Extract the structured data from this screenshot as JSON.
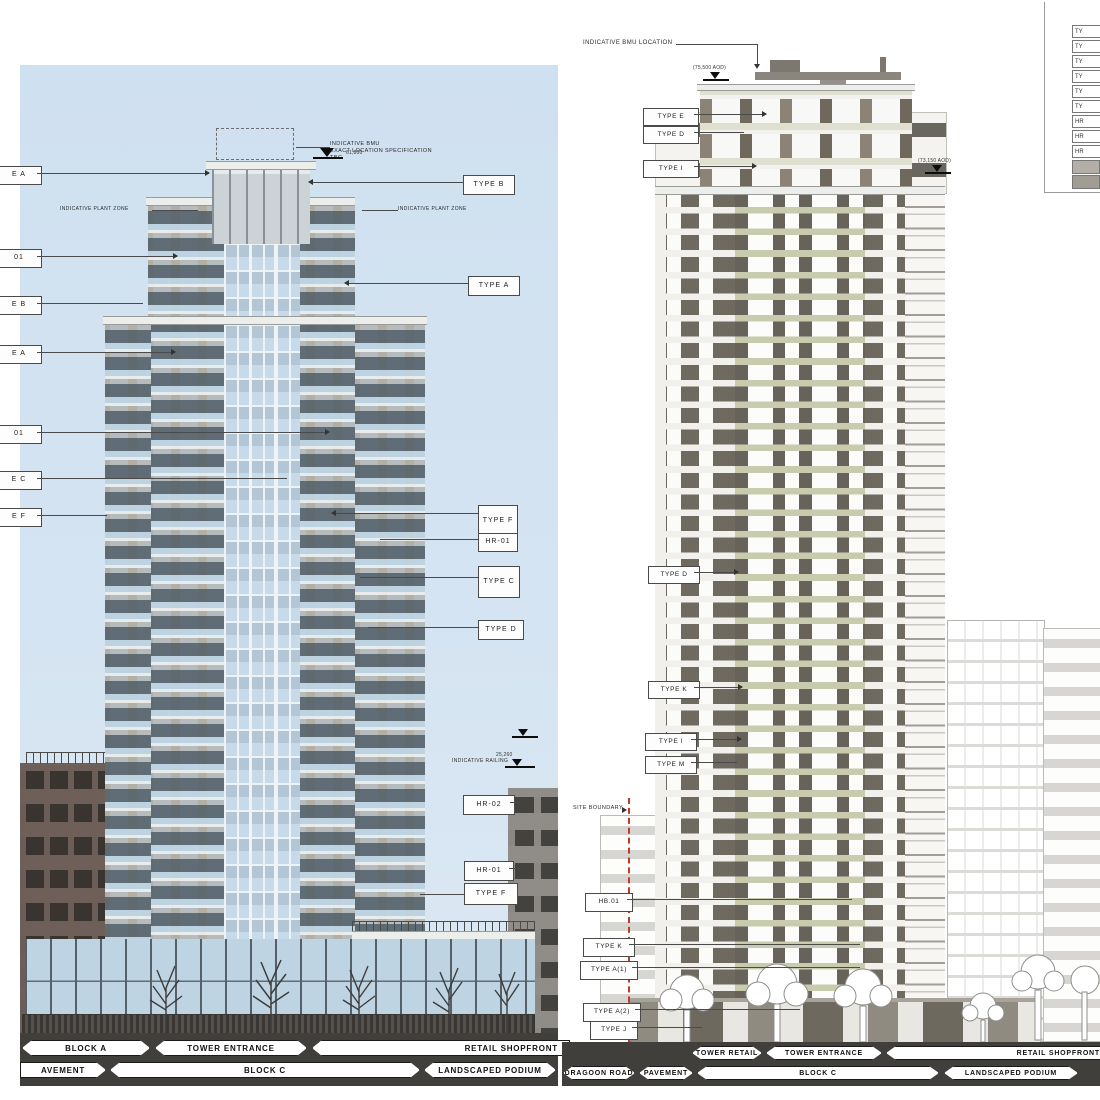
{
  "colors": {
    "sky": "#cfe0f0",
    "boundary_red": "#c0392b",
    "road_band": "#413f3c",
    "left_facade": "#b2afa7",
    "right_facade_dark": "#6f6a60",
    "right_balcony_olive": "#c8cbae"
  },
  "left_panel": {
    "bmu_note_line1": "INDICATIVE BMU",
    "bmu_note_line2": "EXACT LOCATION SPECIFICATION",
    "bmu_note_line3": "TBC",
    "bmu_level": "61,800",
    "plant_zone_left": "INDICATIVE PLANT ZONE",
    "plant_zone_right": "INDICATIVE PLANT ZONE",
    "railing_note": "INDICATIVE RAILING",
    "railing_level": "25,260",
    "edge_labels": [
      "E A",
      "01",
      "E B",
      "E A",
      "01",
      "E C",
      "E F"
    ],
    "right_labels": [
      "TYPE B",
      "TYPE A",
      "TYPE F",
      "HR-01",
      "TYPE C",
      "TYPE D",
      "HR-02",
      "HR-01",
      "TYPE F"
    ],
    "banners_row1": [
      "BLOCK A",
      "TOWER ENTRANCE",
      "RETAIL SHOPFRONT"
    ],
    "banners_row2": [
      "AVEMENT",
      "BLOCK C",
      "LANDSCAPED PODIUM"
    ]
  },
  "right_panel": {
    "bmu_note": "INDICATIVE BMU LOCATION",
    "upper_labels": [
      "TYPE E",
      "TYPE D",
      "TYPE I"
    ],
    "mid_labels": [
      "TYPE D",
      "TYPE K",
      "TYPE I",
      "TYPE M"
    ],
    "site_boundary": "SITE BOUNDARY",
    "lower_labels": [
      "HB.01",
      "TYPE K",
      "TYPE A(1)",
      "TYPE A(2)",
      "TYPE J"
    ],
    "level_left": "(75,500 AOD)",
    "level_right": "(73,150 AOD)",
    "banners_row1": [
      "TOWER RETAIL",
      "TOWER ENTRANCE",
      "RETAIL SHOPFRONT"
    ],
    "banners_row2": [
      "DRAGOON ROAD",
      "PAVEMENT",
      "BLOCK C",
      "LANDSCAPED PODIUM"
    ],
    "legend_items": [
      "TY",
      "TY",
      "TY",
      "TY",
      "TY",
      "TY",
      "HR",
      "HR",
      "HR"
    ]
  }
}
